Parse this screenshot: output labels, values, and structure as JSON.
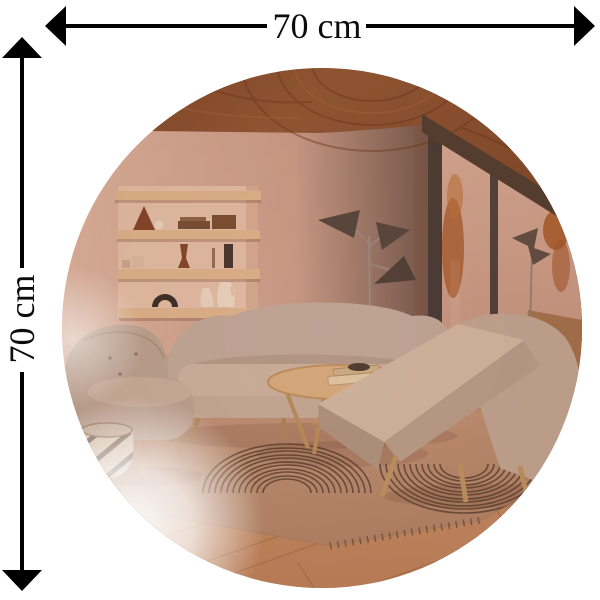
{
  "diagram": {
    "type": "product-dimension-image",
    "subject": "round copper-tinted wall mirror reflecting a living room interior",
    "dimensions": {
      "width": {
        "label": "70 cm",
        "orientation": "horizontal"
      },
      "height": {
        "label": "70 cm",
        "orientation": "vertical"
      }
    }
  },
  "colors": {
    "page_background": "#ffffff",
    "dimension_lines": "#000000",
    "label_text": "#0c0c0c",
    "mirror_tint": "#c79a87",
    "ceiling_wood": "#7c4524",
    "wall": "#cb9e8b",
    "shelf_wood": "#dcb48c",
    "sofa": "#bea89a",
    "rug": "#b98f72",
    "rug_stripes": "#503c2d",
    "floor_wood": "#c08a62",
    "window_frame": "#3d3532",
    "outside_foliage": "#a65a2e"
  },
  "scene": {
    "items": [
      "wood plank ceiling",
      "recessed wall shelves with decor objects",
      "tripod floor lamp with three cone shades",
      "floor-to-ceiling window with autumn foliage view",
      "curved three-seat sofa",
      "round wooden coffee table with books and bowl",
      "wingback armchair",
      "upholstered ottoman",
      "accent armchair with wooden legs",
      "striped area rug with concentric arc pattern",
      "striped woven basket",
      "wood plank floor"
    ]
  }
}
